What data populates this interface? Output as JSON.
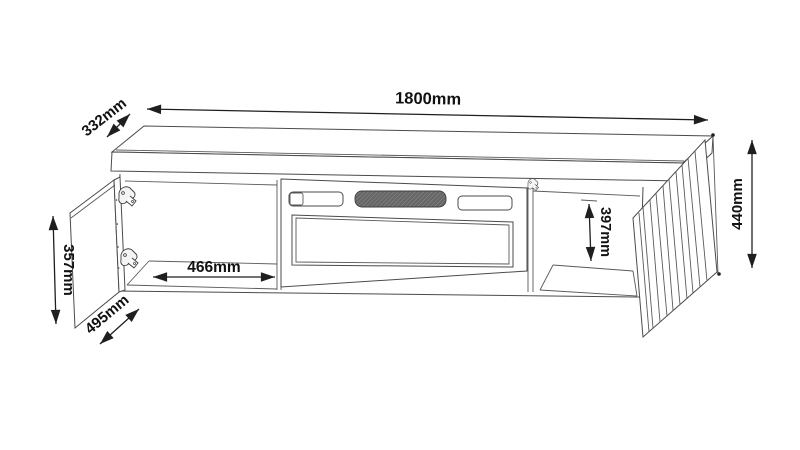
{
  "figure": {
    "kind": "furniture-technical-drawing",
    "subject": "TV stand with fireplace insert, left door and right fluted door open"
  },
  "dimensions": {
    "overall_width": "1800mm",
    "depth": "332mm",
    "overall_height": "440mm",
    "left_door_height": "357mm",
    "left_door_width": "495mm",
    "left_compartment_width": "466mm",
    "right_compartment_height": "397mm"
  },
  "colors": {
    "background": "#ffffff",
    "drawing_line": "#4b4b4b",
    "dimension_line": "#1f1f1f",
    "text": "#111111",
    "vent_fill": "#666666"
  }
}
